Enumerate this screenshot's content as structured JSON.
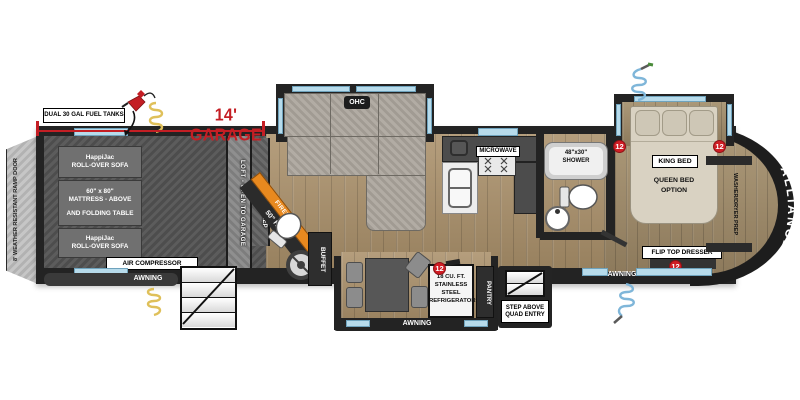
{
  "annotations": {
    "fuel_tanks": "DUAL 30 GAL FUEL TANKS",
    "garage_dim": "14' GARAGE"
  },
  "repeated": {
    "awning": "AWNING",
    "marker": "12"
  },
  "brand": "ALLIANCE",
  "garage": {
    "ramp_door": "8' WEATHER RESISTANT RAMP DOOR",
    "sofa_line1": "HappiJac",
    "sofa_line2": "ROLL-OVER SOFA",
    "mattress_line1": "60\" x 80\"",
    "mattress_line2": "MATTRESS - ABOVE",
    "mattress_line3": "AND FOLDING TABLE",
    "air_compressor": "AIR COMPRESSOR",
    "loft": "LOFT - OPEN TO GARAGE",
    "wd_prep": "W/D PREP"
  },
  "living": {
    "ohc": "OHC",
    "fireplace": "FIREPLACE",
    "tv": "50\" HD TV",
    "buffet": "BUFFET",
    "microwave": "MICROWAVE"
  },
  "dinette_kitchen": {
    "fridge_line1": "18 CU. FT.",
    "fridge_line2": "STAINLESS STEEL",
    "fridge_line3": "REFRIGERATOR",
    "pantry": "PANTRY",
    "entry_line1": "STEP ABOVE",
    "entry_line2": "QUAD ENTRY"
  },
  "bathroom": {
    "shower_line1": "48\"x30\"",
    "shower_line2": "SHOWER"
  },
  "bedroom": {
    "king_bed": "KING BED",
    "queen_line1": "QUEEN BED",
    "queen_line2": "OPTION",
    "flip_dresser": "FLIP TOP DRESSER",
    "washer_dryer": "WASHER/DRYER PREP"
  },
  "colors": {
    "accent_red": "#c41e24",
    "fireplace_orange": "#e8891f",
    "window_blue": "#b7dbeb",
    "cord_yellow": "#dfc05a",
    "hose_blue": "#7fb6d9"
  }
}
